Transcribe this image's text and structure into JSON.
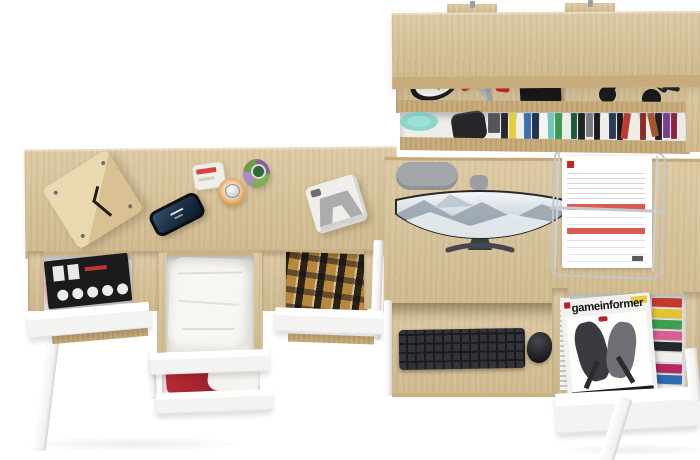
{
  "meta": {
    "description": "Overhead product render of a two-desk oak home office set with white open drawers, a wall shelf with books and accessories, a curved monitor, keyboard, mouse, document tray and magazines",
    "background_color": "#ffffff"
  },
  "palette": {
    "oak": "#d9c397",
    "oak_edge": "#c8ac7b",
    "white_furniture": "#fbfbfb",
    "keyboard_black": "#26272a",
    "chair_gray": "#a3a7aa",
    "red_accent": "#c5232d",
    "teal_glass": "#6fcfc3"
  },
  "wall_shelf": {
    "name": "oak wall shelf with two mounting tabs",
    "middle_shelf_items": [
      "alarm-clock",
      "pocket-knife",
      "key-bunch-with-red-fob",
      "black-tray-with-round-wooden-brush",
      "lipsticks",
      "makeup-powder-brushes"
    ],
    "bottom_shelf_items": [
      "teal-glass-bowl",
      "black-box",
      "row-of-books"
    ],
    "books": [
      {
        "c": "#54555a",
        "h": 20,
        "w": 13
      },
      {
        "c": "#26272b",
        "h": 26
      },
      {
        "c": "#e6cf35",
        "h": 27
      },
      {
        "c": "#f1f1ee",
        "h": 25
      },
      {
        "c": "#3a6fb5",
        "h": 27
      },
      {
        "c": "#23344f",
        "h": 26
      },
      {
        "c": "#f4f4f1",
        "h": 24
      },
      {
        "c": "#6cc7bd",
        "h": 26
      },
      {
        "c": "#3c9a4e",
        "h": 27
      },
      {
        "c": "#ecece9",
        "h": 23
      },
      {
        "c": "#1d5c38",
        "h": 26
      },
      {
        "c": "#222226",
        "h": 27
      },
      {
        "c": "#787b80",
        "h": 24
      },
      {
        "c": "#1a1b1f",
        "h": 27
      },
      {
        "c": "#f0efec",
        "h": 22
      },
      {
        "c": "#2c3a59",
        "h": 26
      },
      {
        "c": "#191a1e",
        "h": 27
      },
      {
        "c": "#bf3a2e",
        "h": 26,
        "r": 8
      },
      {
        "c": "#efede8",
        "h": 24,
        "r": 10
      },
      {
        "c": "#8c2a28",
        "h": 27
      },
      {
        "c": "#a4562f",
        "h": 24,
        "r": -12
      },
      {
        "c": "#202125",
        "h": 27
      },
      {
        "c": "#7c3f8c",
        "h": 25
      },
      {
        "c": "#8c2340",
        "h": 26
      },
      {
        "c": "#eceae6",
        "h": 22
      }
    ]
  },
  "left_desk": {
    "name": "oak desk with three open white drawers and white angled legs",
    "tabletop_items": [
      "wooden-cube-clock",
      "smartphone",
      "three-perfume-bottles",
      "instant-camera"
    ],
    "drawers": [
      {
        "contents": "magazines"
      },
      {
        "contents": "white folded clothes"
      },
      {
        "contents": "red and white clothes"
      },
      {
        "contents": "brown checked shirts"
      }
    ]
  },
  "right_desk": {
    "name": "oak desk with curved monitor, pull-out keyboard shelf and open magazine drawer",
    "items": [
      "office-chair-backrest",
      "curved-widescreen-monitor",
      "wire-document-tray",
      "wireless-keyboard",
      "mouse"
    ],
    "documents": "invoices with red header bands",
    "magazine": {
      "title": "gameinformer"
    },
    "magazine_edge_colors": [
      "#c23a2f",
      "#e3c334",
      "#3f9e4f",
      "#d75f93",
      "#27282c",
      "#f0efec",
      "#b32a63",
      "#2e6bb0"
    ]
  }
}
